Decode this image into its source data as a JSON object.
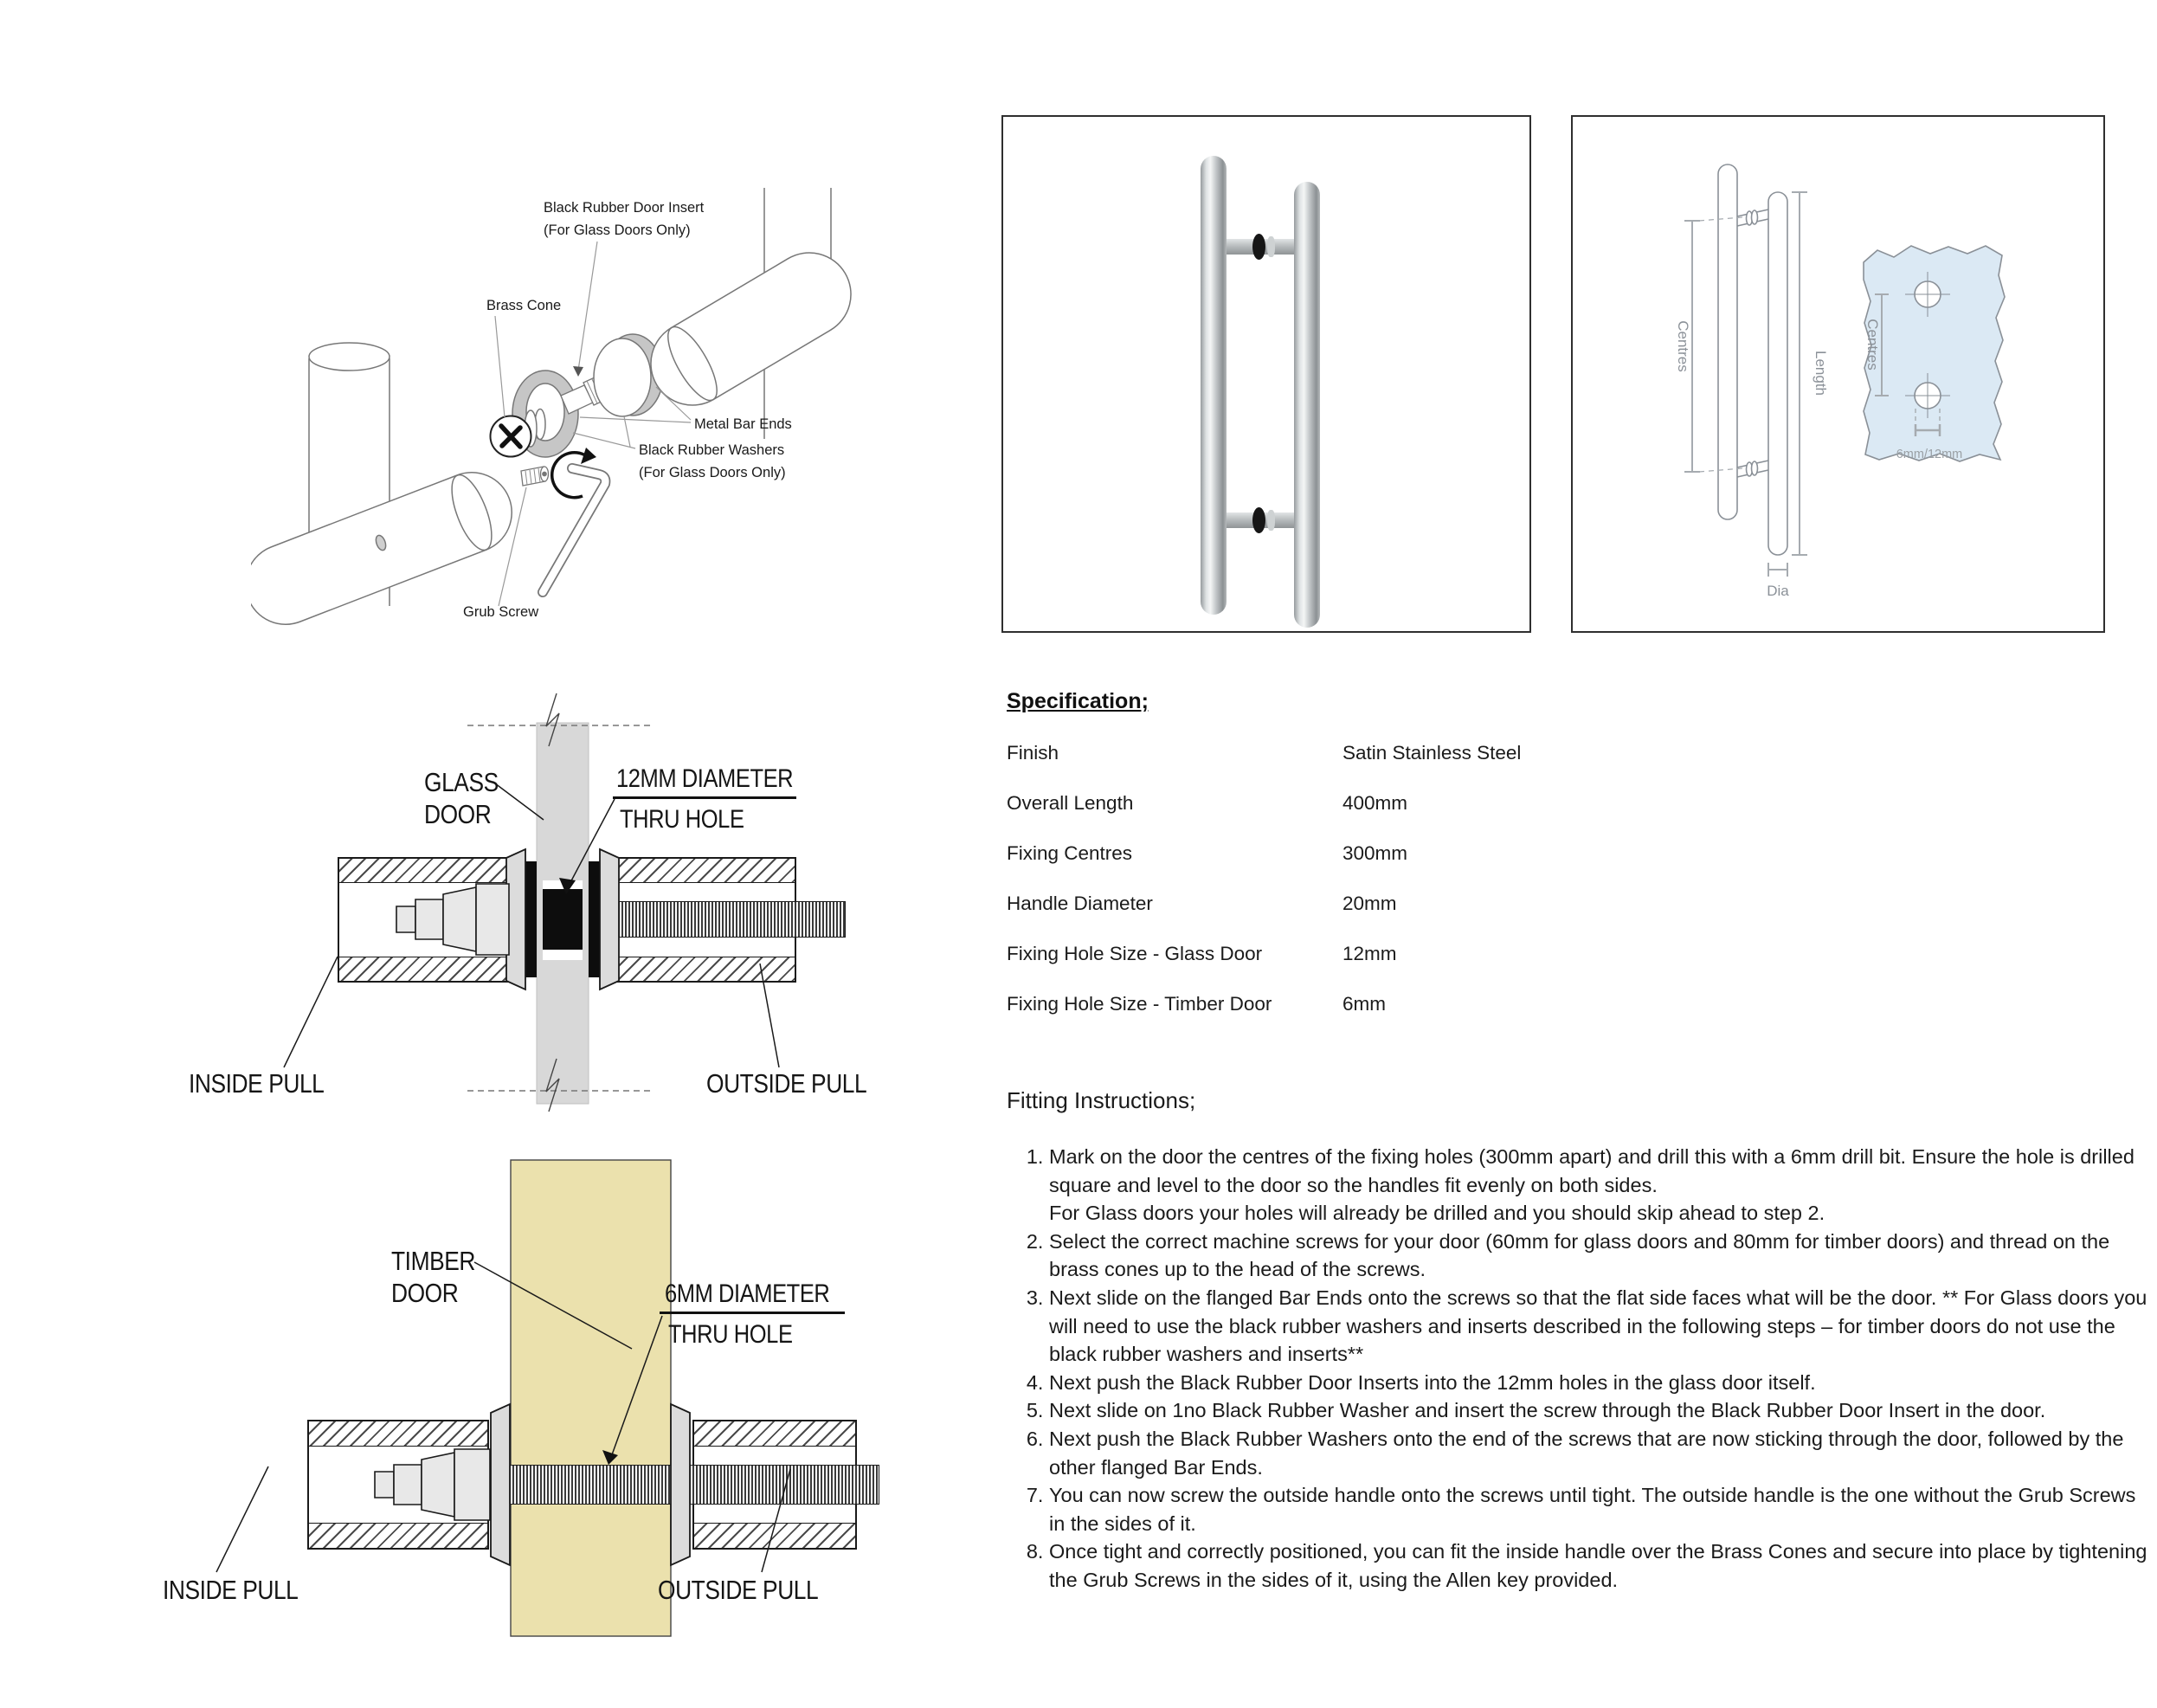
{
  "exploded": {
    "labels": {
      "insert_line1": "Black Rubber Door Insert",
      "insert_line2": "(For Glass Doors Only)",
      "brass_cone": "Brass Cone",
      "metal_bar_ends": "Metal Bar Ends",
      "washers_line1": "Black Rubber Washers",
      "washers_line2": "(For Glass Doors Only)",
      "grub_screw": "Grub Screw"
    }
  },
  "dimension_drawing": {
    "centres": "Centres",
    "length": "Length",
    "dia": "Dia",
    "panel_centres": "Centres",
    "hole_size": "6mm/12mm",
    "panel_color": "#dbe9f4"
  },
  "glass_section": {
    "door_line1": "GLASS",
    "door_line2": "DOOR",
    "hole_line1": "12MM DIAMETER",
    "hole_line2": "THRU HOLE",
    "inside": "INSIDE PULL",
    "outside": "OUTSIDE PULL",
    "door_color": "#d8d8d8"
  },
  "timber_section": {
    "door_line1": "TIMBER",
    "door_line2": "DOOR",
    "hole_line1": "6MM DIAMETER",
    "hole_line2": "THRU HOLE",
    "inside": "INSIDE PULL",
    "outside": "OUTSIDE PULL",
    "door_color": "#ebe1ad"
  },
  "spec": {
    "title": "Specification;",
    "rows": [
      {
        "label": "Finish",
        "value": "Satin Stainless Steel"
      },
      {
        "label": "Overall Length",
        "value": "400mm"
      },
      {
        "label": "Fixing Centres",
        "value": "300mm"
      },
      {
        "label": "Handle Diameter",
        "value": "20mm"
      },
      {
        "label": "Fixing Hole Size - Glass Door",
        "value": "12mm"
      },
      {
        "label": "Fixing Hole Size - Timber Door",
        "value": "6mm"
      }
    ]
  },
  "fitting": {
    "title": "Fitting Instructions;",
    "steps": [
      "Mark on the door the centres of the fixing holes (300mm apart) and drill this with a 6mm drill bit. Ensure the hole is drilled square and level to the door so the handles fit evenly on both sides.\nFor Glass doors your holes will already be drilled and you should skip ahead to step 2.",
      "Select the correct machine screws for your door (60mm for glass doors and 80mm for timber doors) and thread on the brass cones up to the head of the screws.",
      "Next slide on the flanged Bar Ends onto the screws so that the flat side faces what will be the door. ** For Glass doors you will need to use the black rubber washers and inserts described in the following steps – for timber doors do not use the black rubber washers and inserts**",
      "Next push the Black Rubber Door Inserts into the 12mm holes in the glass door itself.",
      "Next slide on 1no Black Rubber Washer and insert the screw through the Black Rubber Door Insert in the door.",
      "Next push the Black Rubber Washers onto the end of the screws that are now sticking through the door, followed by the other flanged Bar Ends.",
      "You can now screw the outside handle onto the screws until tight. The outside handle is the one without the Grub Screws in the sides of it.",
      "Once tight and correctly positioned, you can fit the inside handle over the Brass Cones and secure into place by tightening the Grub Screws in the sides of it, using the Allen key provided."
    ]
  }
}
